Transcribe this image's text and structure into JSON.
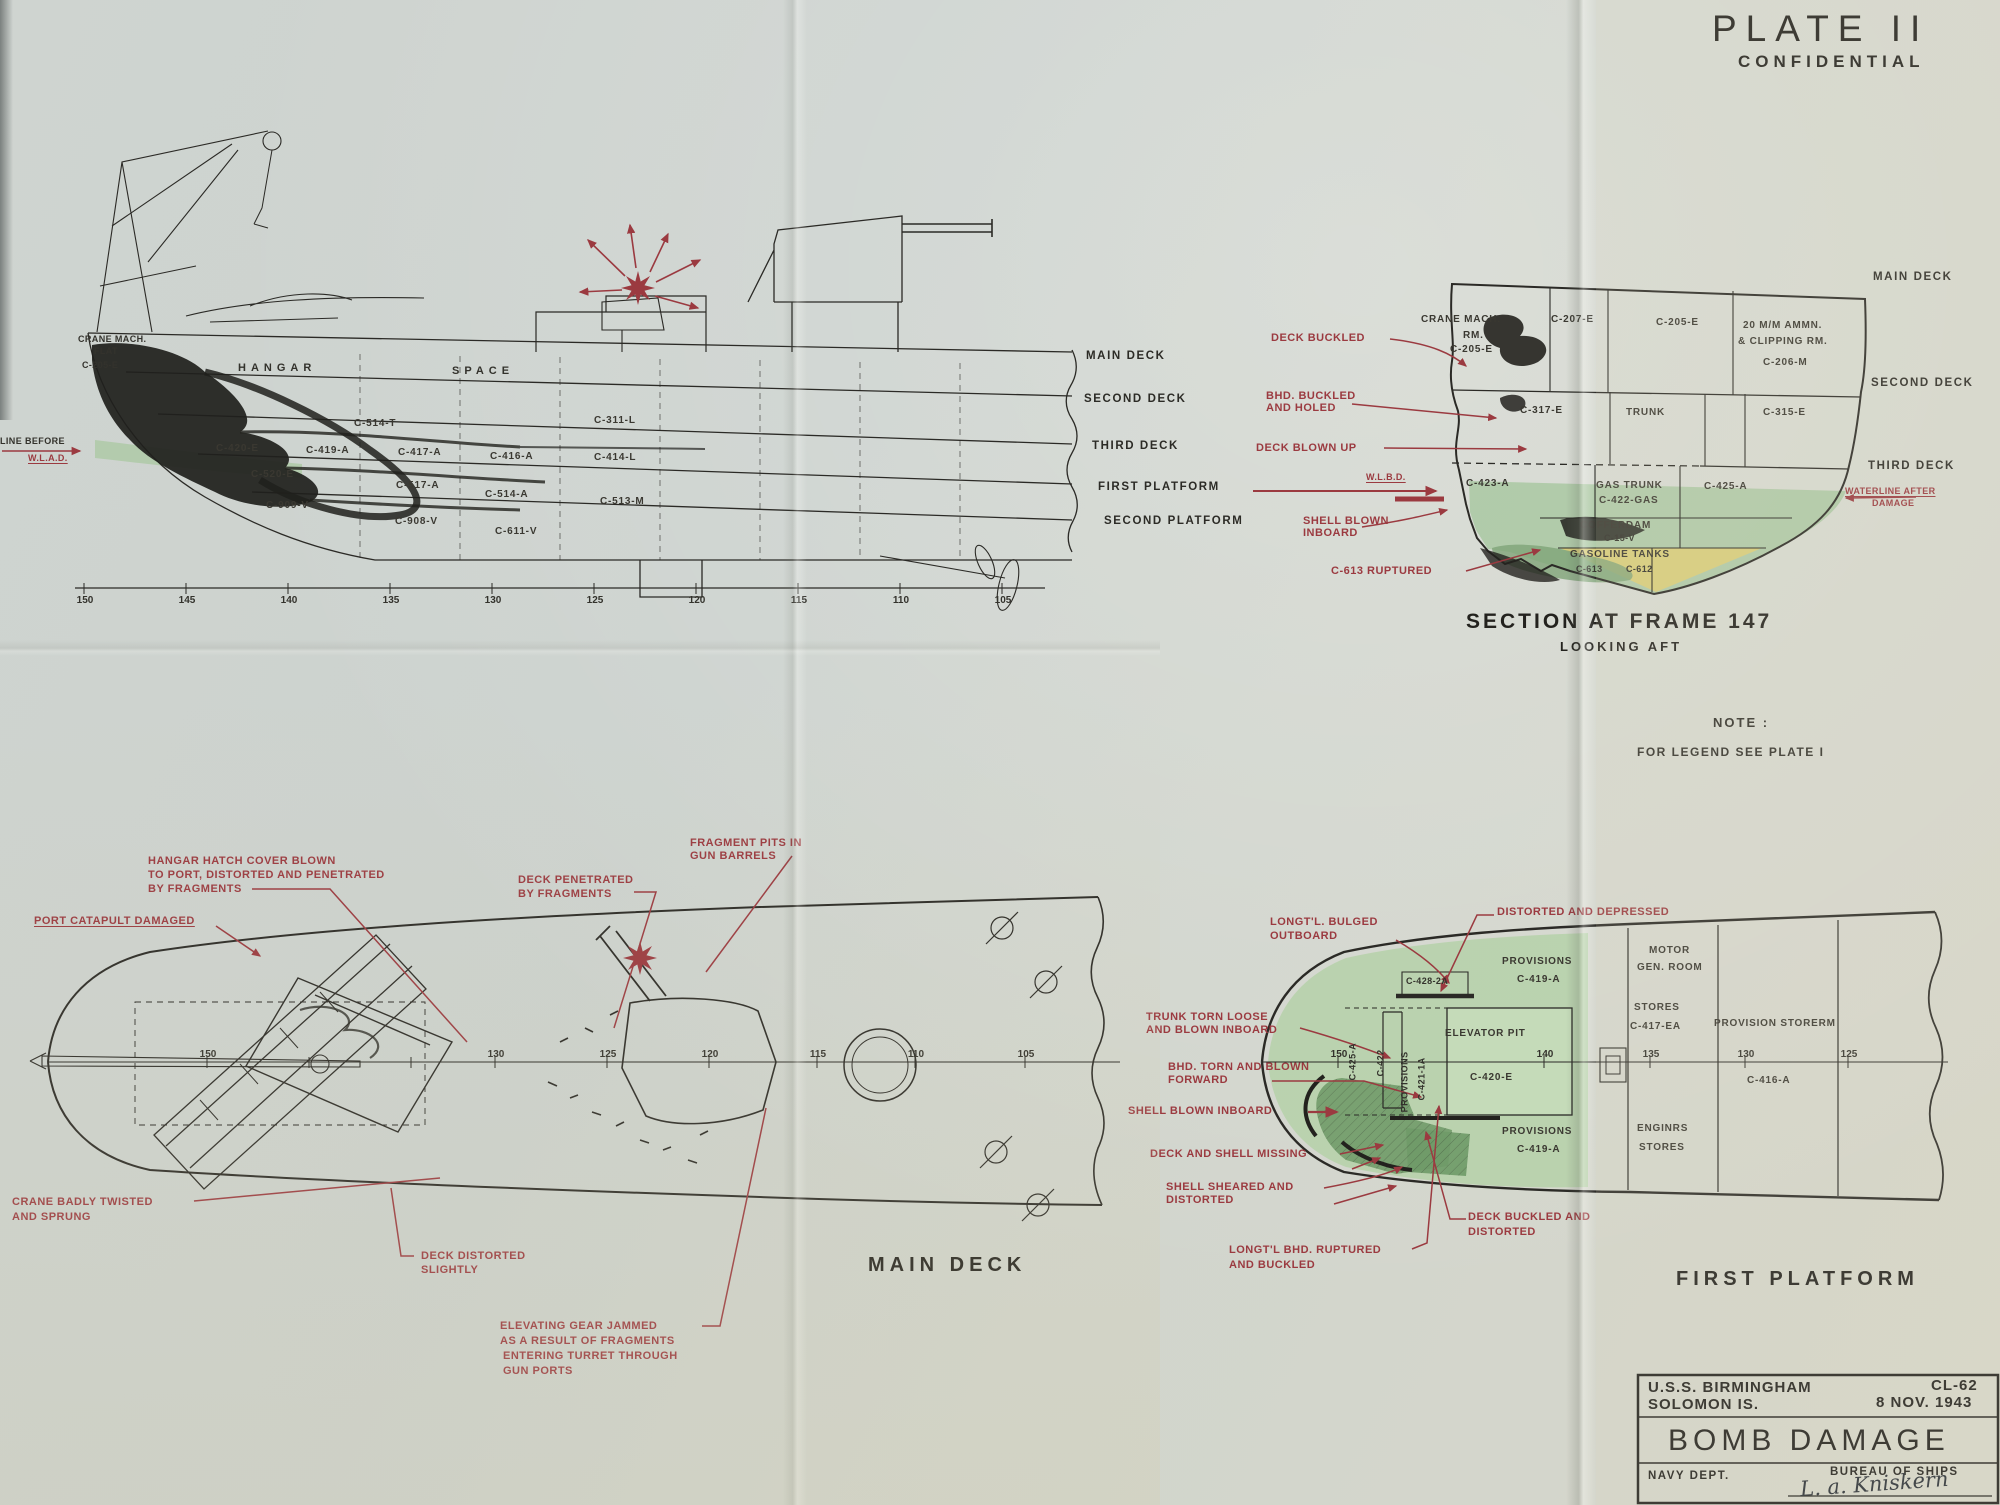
{
  "colors": {
    "paper": "#d2d6cf",
    "ink": "#2b2a26",
    "red": "#9b3a40",
    "green": "#aecaa4",
    "dark_green": "#79a171",
    "yellow": "#d9ce7c"
  },
  "plate": {
    "title": "PLATE II",
    "classification": "CONFIDENTIAL"
  },
  "note": {
    "heading": "NOTE :",
    "body": "FOR LEGEND SEE PLATE I"
  },
  "elevation": {
    "labels": {
      "crane_mach": "CRANE MACH.",
      "crane_flat": "FLAT",
      "crane_no": "C-205-E",
      "hangar": "HANGAR",
      "space": "SPACE",
      "c514t": "C-514-T",
      "c311l": "C-311-L",
      "c420e": "C-420-E",
      "c419a": "C-419-A",
      "c417a": "C-417-A",
      "c416a": "C-416-A",
      "c414l": "C-414-L",
      "c520e": "C-520-E",
      "c517a": "C-517-A",
      "c514a": "C-514-A",
      "c513m": "C-513-M",
      "c909v": "C-909-V",
      "c908v": "C-908-V",
      "c611v": "C-611-V"
    },
    "decks": [
      "MAIN DECK",
      "SECOND DECK",
      "THIRD DECK",
      "FIRST PLATFORM",
      "SECOND PLATFORM"
    ],
    "waterline_before": "LINE BEFORE",
    "wlad": "W.L.A.D.",
    "frames": [
      "150",
      "145",
      "140",
      "135",
      "130",
      "125",
      "120",
      "115",
      "110",
      "105"
    ]
  },
  "section": {
    "title": "SECTION AT FRAME 147",
    "subtitle": "LOOKING AFT",
    "decks": [
      "MAIN DECK",
      "SECOND DECK",
      "THIRD DECK"
    ],
    "rooms": {
      "crane1": "CRANE MACH.",
      "crane2": "RM.",
      "crane3": "C-205-E",
      "c207": "C-207-E",
      "c205": "C-205-E",
      "ammo1": "20 M/M AMMN.",
      "ammo2": "& CLIPPING RM.",
      "ammo3": "C-206-M",
      "c317": "C-317-E",
      "trunk": "TRUNK",
      "c315": "C-315-E",
      "c423": "C-423-A",
      "gas1": "GAS TRUNK",
      "gas2": "C-422-GAS",
      "c425": "C-425-A",
      "coff1": "COFFERDAM",
      "coff2": "C-15-V",
      "gastank": "GASOLINE TANKS",
      "t613": "C-613",
      "t612": "C-612"
    },
    "ann": {
      "deck_buckled": "DECK BUCKLED",
      "bhd1": "BHD. BUCKLED",
      "bhd2": "AND HOLED",
      "deck_blown": "DECK BLOWN UP",
      "wlbd": "W.L.B.D.",
      "shell1": "SHELL BLOWN",
      "shell2": "INBOARD",
      "c613r": "C-613 RUPTURED",
      "wl_after1": "WATERLINE AFTER",
      "wl_after2": "DAMAGE"
    }
  },
  "main_deck": {
    "title": "MAIN DECK",
    "frames": [
      "150",
      "130",
      "125",
      "120",
      "115",
      "110",
      "105"
    ],
    "ann": {
      "hatch1": "HANGAR HATCH COVER BLOWN",
      "hatch2": "TO PORT, DISTORTED AND PENETRATED",
      "hatch3": "BY FRAGMENTS",
      "catapult": "PORT CATAPULT DAMAGED",
      "pen1": "DECK PENETRATED",
      "pen2": "BY FRAGMENTS",
      "frag1": "FRAGMENT PITS IN",
      "frag2": "GUN BARRELS",
      "crane1": "CRANE BADLY TWISTED",
      "crane2": "AND SPRUNG",
      "dist1": "DECK DISTORTED",
      "dist2": "SLIGHTLY",
      "elev1": "ELEVATING GEAR JAMMED",
      "elev2": "AS A RESULT OF FRAGMENTS",
      "elev3": "ENTERING TURRET THROUGH",
      "elev4": "GUN PORTS"
    }
  },
  "first_platform": {
    "title": "FIRST PLATFORM",
    "frames": [
      "150",
      "140",
      "135",
      "130",
      "125"
    ],
    "rooms": {
      "prov_top1": "PROVISIONS",
      "prov_top2": "C-419-A",
      "motor1": "MOTOR",
      "motor2": "GEN. ROOM",
      "stores1": "STORES",
      "stores2": "C-417-EA",
      "prov_srm": "PROVISION STORERM",
      "elevator": "ELEVATOR PIT",
      "c420": "C-420-E",
      "c416": "C-416-A",
      "prov_bot1": "PROVISIONS",
      "prov_bot2": "C-419-A",
      "eng1": "ENGINRS",
      "eng2": "STORES",
      "c425v": "C-425-A",
      "c422v": "C-422",
      "provv": "PROVISIONS",
      "c421v": "C-421-1A",
      "c428": "C-428-2A"
    },
    "ann": {
      "bulge1": "LONGT'L. BULGED",
      "bulge2": "OUTBOARD",
      "depressed": "DISTORTED AND DEPRESSED",
      "trunk1": "TRUNK TORN LOOSE",
      "trunk2": "AND BLOWN INBOARD",
      "bhd1": "BHD. TORN AND BLOWN",
      "bhd2": "FORWARD",
      "shell_in": "SHELL BLOWN INBOARD",
      "missing": "DECK AND SHELL MISSING",
      "shear1": "SHELL SHEARED AND",
      "shear2": "DISTORTED",
      "lbhd1": "LONGT'L BHD. RUPTURED",
      "lbhd2": "AND BUCKLED",
      "buck1": "DECK BUCKLED AND",
      "buck2": "DISTORTED"
    }
  },
  "titleblock": {
    "ship": "U.S.S. BIRMINGHAM",
    "hull": "CL-62",
    "place": "SOLOMON IS.",
    "date": "8 NOV. 1943",
    "title": "BOMB DAMAGE",
    "dept": "NAVY DEPT.",
    "bureau": "BUREAU OF SHIPS",
    "signature": "L. a. Kniskern"
  }
}
